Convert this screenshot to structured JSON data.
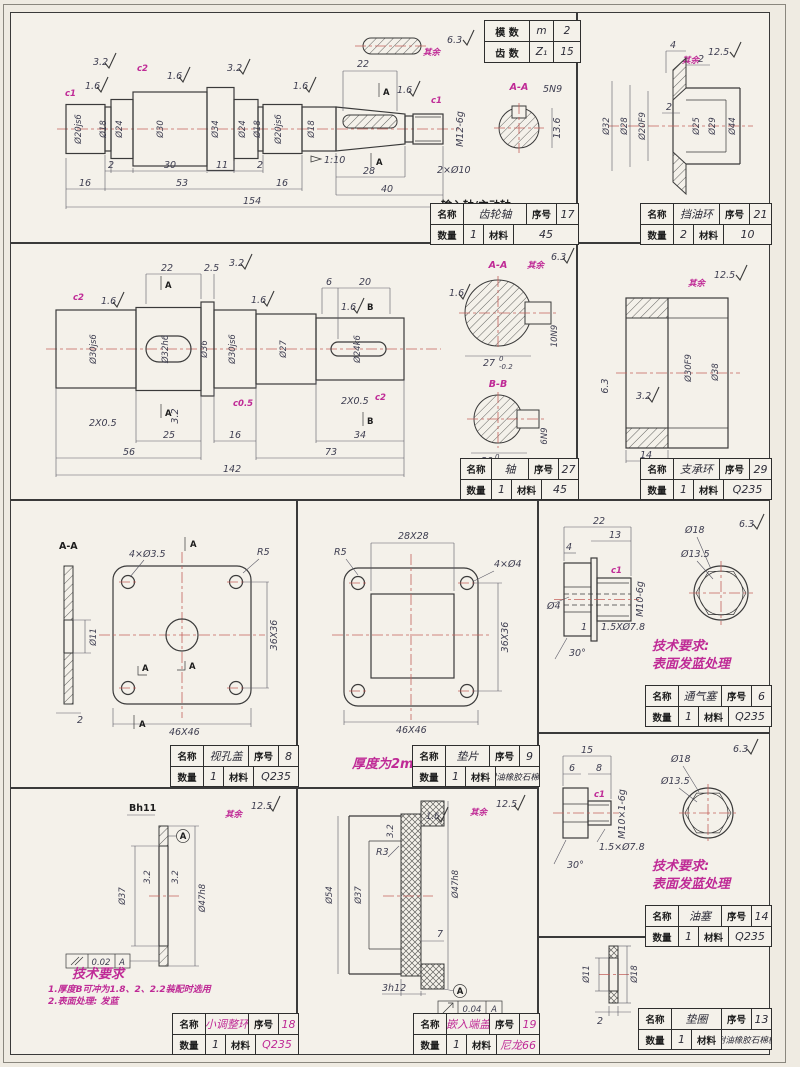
{
  "common": {
    "qiyu": "其余"
  },
  "tb_labels": {
    "name": "名称",
    "seq": "序号",
    "qty": "数量",
    "mat": "材料"
  },
  "gear_table": {
    "r1": {
      "label": "模 数",
      "sym": "m",
      "val": "2"
    },
    "r2": {
      "label": "齿 数",
      "sym": "Z₁",
      "val": "15"
    }
  },
  "parts": {
    "gear_shaft": {
      "finish": "6.3",
      "subtitle": "输入轴/主动轴",
      "tb": {
        "name": "齿轮轴",
        "seq": "17",
        "qty": "1",
        "mat": "45"
      },
      "marks": {
        "c1a": "c1",
        "r16a": "1.6",
        "r32a": "3.2",
        "c2": "c2",
        "r16b": "1.6",
        "r32b": "3.2",
        "r16c": "1.6",
        "r16d": "1.6",
        "c1b": "c1",
        "taper": "1:10",
        "a": "A"
      },
      "thread": "M12-6g",
      "holes": "2×Ø10",
      "dias": [
        "Ø20js6",
        "Ø18",
        "Ø24",
        "Ø30",
        "Ø34",
        "Ø24",
        "Ø18",
        "Ø20js6",
        "Ø18"
      ],
      "dims": {
        "kw": "22",
        "g2a": "2",
        "d30": "30",
        "d11": "11",
        "g2b": "2",
        "d16a": "16",
        "d53": "53",
        "d16b": "16",
        "d154": "154",
        "d28": "28",
        "d40": "40"
      },
      "sec": {
        "label": "A-A",
        "key": "5N9",
        "depth": "13.6"
      }
    },
    "oil_ring": {
      "finish": "12.5",
      "tb": {
        "name": "挡油环",
        "seq": "21",
        "qty": "2",
        "mat": "10"
      },
      "dims": {
        "d4": "4",
        "d2a": "2",
        "d2b": "2"
      },
      "dias": [
        "Ø32",
        "Ø28",
        "Ø20F9",
        "Ø25",
        "Ø29",
        "Ø44"
      ]
    },
    "out_shaft": {
      "finish": "6.3",
      "subtitle": "输出轴/从动轴",
      "tb": {
        "name": "轴",
        "seq": "27",
        "qty": "1",
        "mat": "45"
      },
      "marks": {
        "c2a": "c2",
        "r16a": "1.6",
        "r32a": "3.2",
        "r16b": "1.6",
        "c05": "c0.5",
        "r16c": "1.6",
        "r32b": "3.2",
        "c2b": "c2",
        "a": "A",
        "b": "B",
        "ch1": "2X0.5",
        "ch2": "2X0.5",
        "r16s": "1.6"
      },
      "dias": [
        "Ø30js6",
        "Ø32h6",
        "Ø36",
        "Ø30js6",
        "Ø27",
        "Ø24k6"
      ],
      "dims": {
        "d22": "22",
        "d25t": "2.5",
        "d6": "6",
        "d20": "20",
        "d25": "25",
        "d16": "16",
        "d34": "34",
        "d56": "56",
        "d73": "73",
        "d142": "142"
      },
      "secA": {
        "label": "A-A",
        "dim": "27",
        "tt": "0",
        "tbv": "-0.2",
        "key": "10N9"
      },
      "secB": {
        "label": "B-B",
        "dim": "20",
        "tt": "0",
        "tbv": "-0.1",
        "key": "6N9"
      }
    },
    "support_ring": {
      "finish": "12.5",
      "tb": {
        "name": "支承环",
        "seq": "29",
        "qty": "1",
        "mat": "Q235"
      },
      "marks": {
        "r63": "6.3",
        "r32": "3.2"
      },
      "dias": [
        "Ø30F9",
        "Ø38"
      ],
      "dims": {
        "w": "14"
      }
    },
    "cover": {
      "tb": {
        "name": "视孔盖",
        "seq": "8",
        "qty": "1",
        "mat": "Q235"
      },
      "labels": {
        "sec": "A-A",
        "holes": "4×Ø3.5",
        "r5": "R5",
        "bore": "Ø11",
        "t": "2",
        "sq36": "36X36",
        "sq46": "46X46",
        "a": "A"
      }
    },
    "gasket": {
      "tb": {
        "name": "垫片",
        "seq": "9",
        "qty": "1",
        "mat": "耐油橡胶石棉板"
      },
      "labels": {
        "sq28": "28X28",
        "r5": "R5",
        "holes": "4×Ø4",
        "sq36": "36X36",
        "sq46": "46X46"
      },
      "note": "厚度为2mm"
    },
    "breather": {
      "finish": "6.3",
      "tb": {
        "name": "通气塞",
        "seq": "6",
        "qty": "1",
        "mat": "Q235"
      },
      "dims": {
        "d22": "22",
        "d13": "13",
        "d4": "4",
        "dia4": "Ø4",
        "thread": "M10-6g",
        "c1": "c1",
        "d1": "1",
        "cham": "1.5XØ7.8",
        "ang": "30°",
        "d18": "Ø18",
        "d135": "Ø13.5"
      },
      "tech": {
        "t1": "技术要求:",
        "t2": "表面发蓝处理"
      }
    },
    "oil_plug": {
      "finish": "6.3",
      "tb": {
        "name": "油塞",
        "seq": "14",
        "qty": "1",
        "mat": "Q235"
      },
      "dims": {
        "d15": "15",
        "d6": "6",
        "d8": "8",
        "thread": "M10×1-6g",
        "c1": "c1",
        "cham": "1.5×Ø7.8",
        "ang": "30°",
        "d18": "Ø18",
        "d135": "Ø13.5"
      },
      "tech": {
        "t1": "技术要求:",
        "t2": "表面发蓝处理"
      }
    },
    "adj_ring": {
      "finish": "12.5",
      "tb": {
        "name": "小调整环",
        "seq": "18",
        "qty": "1",
        "mat": "Q235"
      },
      "labels": {
        "b": "Bh11",
        "d37": "Ø37",
        "d47": "Ø47h8",
        "r32a": "3.2",
        "r32b": "3.2",
        "tolv": "0.02",
        "tola": "A",
        "datum": "A"
      },
      "tech": {
        "title": "技术要求",
        "l1": "1.厚度B可冲为1.8、2、2.2装配时选用",
        "l2": "2.表面处理: 发蓝"
      }
    },
    "end_cap": {
      "finish": "12.5",
      "tb": {
        "name": "嵌入端盖",
        "seq": "19",
        "qty": "1",
        "mat": "尼龙66"
      },
      "labels": {
        "d54": "Ø54",
        "d37": "Ø37",
        "d47": "Ø47h8",
        "r3": "R3",
        "d7": "7",
        "b3": "3h12",
        "tolv": "0.04",
        "tola": "A",
        "datum": "A",
        "r32": "3.2",
        "r16": "1.6"
      }
    },
    "washer": {
      "tb": {
        "name": "垫圈",
        "seq": "13",
        "qty": "1",
        "mat": "耐油橡胶石棉板"
      },
      "labels": {
        "d11": "Ø11",
        "d18": "Ø18",
        "t": "2"
      }
    }
  }
}
